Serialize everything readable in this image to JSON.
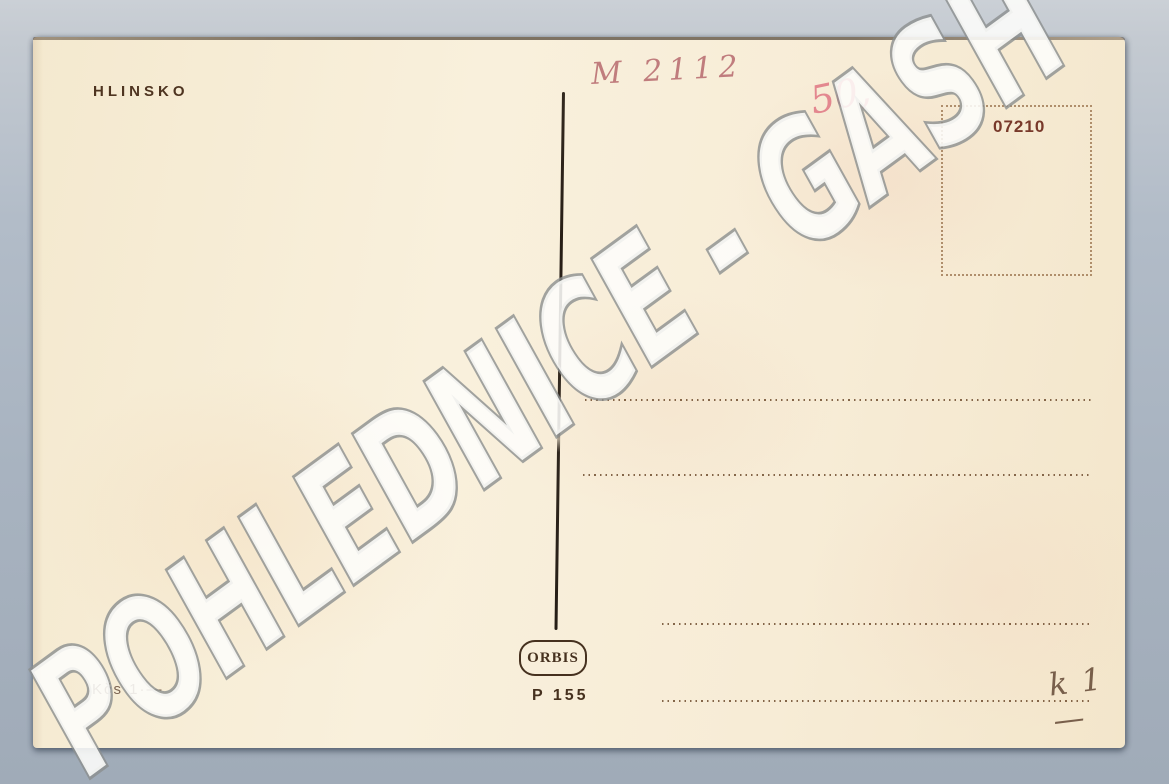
{
  "image_type": "scanned vintage postcard back",
  "watermark": {
    "text": "POHLEDNICE - GASH"
  },
  "postcard": {
    "location_title": "HLINSKO",
    "handwritten_catalog_number": "M 2112",
    "handwritten_price": "50,",
    "stamp_box_number": "07210",
    "publisher_logo": "ORBIS",
    "print_code": "P 155",
    "printed_price": "Kčs 1·—",
    "handwritten_note_bottom_right": "k 1 —",
    "address_lines_count": 4
  },
  "colors": {
    "scan_background": "#a8b3c0",
    "card_paper": "#f7ecd6",
    "printed_ink": "#46311f",
    "handwriting_red": "#b05c63",
    "handwriting_pink": "#df7682",
    "watermark_fill": "#fdfdfa",
    "watermark_outline": "#8b8f8e"
  }
}
